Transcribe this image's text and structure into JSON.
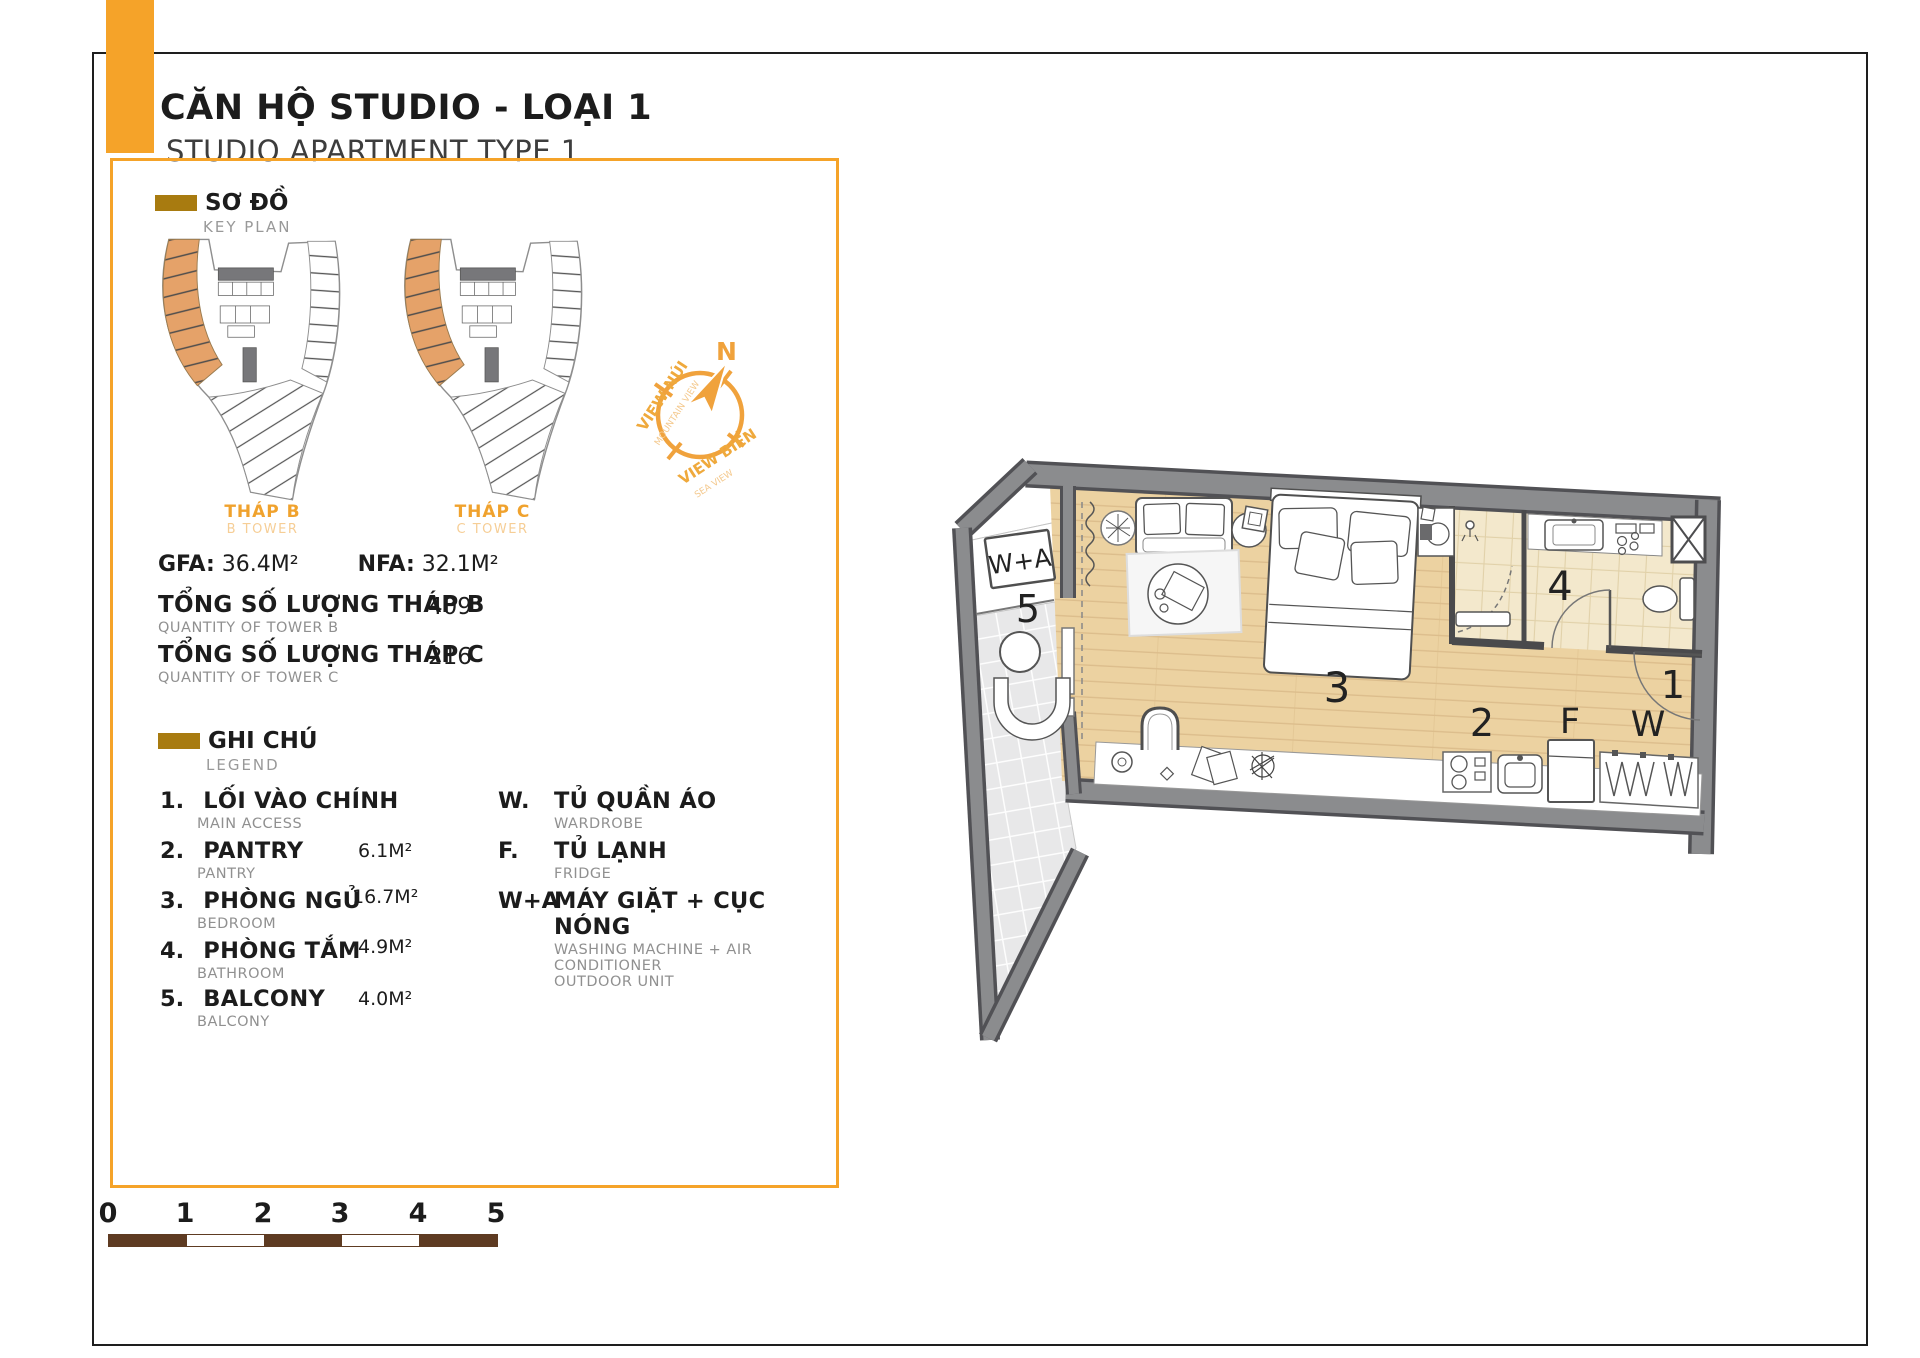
{
  "header": {
    "title_vi": "CĂN HỘ STUDIO - LOẠI 1",
    "title_en": "STUDIO APARTMENT TYPE 1"
  },
  "key_plan": {
    "heading_vi": "SƠ ĐỒ",
    "heading_en": "KEY PLAN",
    "tower_b_vi": "THÁP B",
    "tower_b_en": "B TOWER",
    "tower_c_vi": "THÁP C",
    "tower_c_en": "C TOWER"
  },
  "compass": {
    "north": "N",
    "view1_vi": "VIEW NÚI",
    "view1_en": "MOUNTAIN VIEW",
    "view2_vi": "VIEW BIỂN",
    "view2_en": "SEA VIEW"
  },
  "stats": {
    "gfa_label": "GFA:",
    "gfa_value": "36.4M²",
    "nfa_label": "NFA:",
    "nfa_value": "32.1M²",
    "qty_b_vi": "TỔNG SỐ LƯỢNG THÁP B",
    "qty_b_en": "QUANTITY OF TOWER B",
    "qty_b_value": "409",
    "qty_c_vi": "TỔNG SỐ LƯỢNG THÁP C",
    "qty_c_en": "QUANTITY OF TOWER C",
    "qty_c_value": "216"
  },
  "legend": {
    "heading_vi": "GHI CHÚ",
    "heading_en": "LEGEND",
    "items": [
      {
        "key": "1.",
        "vi": "LỐI VÀO CHÍNH",
        "en": "MAIN ACCESS",
        "area": ""
      },
      {
        "key": "2.",
        "vi": "PANTRY",
        "en": "PANTRY",
        "area": "6.1M²"
      },
      {
        "key": "3.",
        "vi": "PHÒNG NGỦ",
        "en": "BEDROOM",
        "area": "16.7M²"
      },
      {
        "key": "4.",
        "vi": "PHÒNG TẮM",
        "en": "BATHROOM",
        "area": "4.9M²"
      },
      {
        "key": "5.",
        "vi": "BALCONY",
        "en": "BALCONY",
        "area": "4.0M²"
      }
    ],
    "items_right": [
      {
        "key": "W.",
        "vi": "TỦ QUẦN ÁO",
        "en": "WARDROBE",
        "en2": ""
      },
      {
        "key": "F.",
        "vi": "TỦ LẠNH",
        "en": "FRIDGE",
        "en2": ""
      },
      {
        "key": "W+A",
        "vi": "MÁY GIẶT + CỤC NÓNG",
        "en": "WASHING MACHINE + AIR CONDITIONER",
        "en2": "OUTDOOR UNIT"
      }
    ]
  },
  "floor_plan": {
    "labels": {
      "entry": "1",
      "pantry": "2",
      "bedroom": "3",
      "bath": "4",
      "balcony": "5",
      "fridge": "F",
      "wardrobe": "W",
      "washer": "W+A"
    }
  },
  "scale_bar": {
    "ticks": [
      "0",
      "1",
      "2",
      "3",
      "4",
      "5"
    ]
  },
  "colors": {
    "accent_orange": "#F5A329",
    "keyplan_orange": "#E5A269",
    "gold_swatch": "#A87B10",
    "scale_brown": "#5E3B22",
    "wall_gray": "#89898C",
    "wood_floor": "#ECD2A1",
    "bath_tile": "#F3E8CC"
  }
}
